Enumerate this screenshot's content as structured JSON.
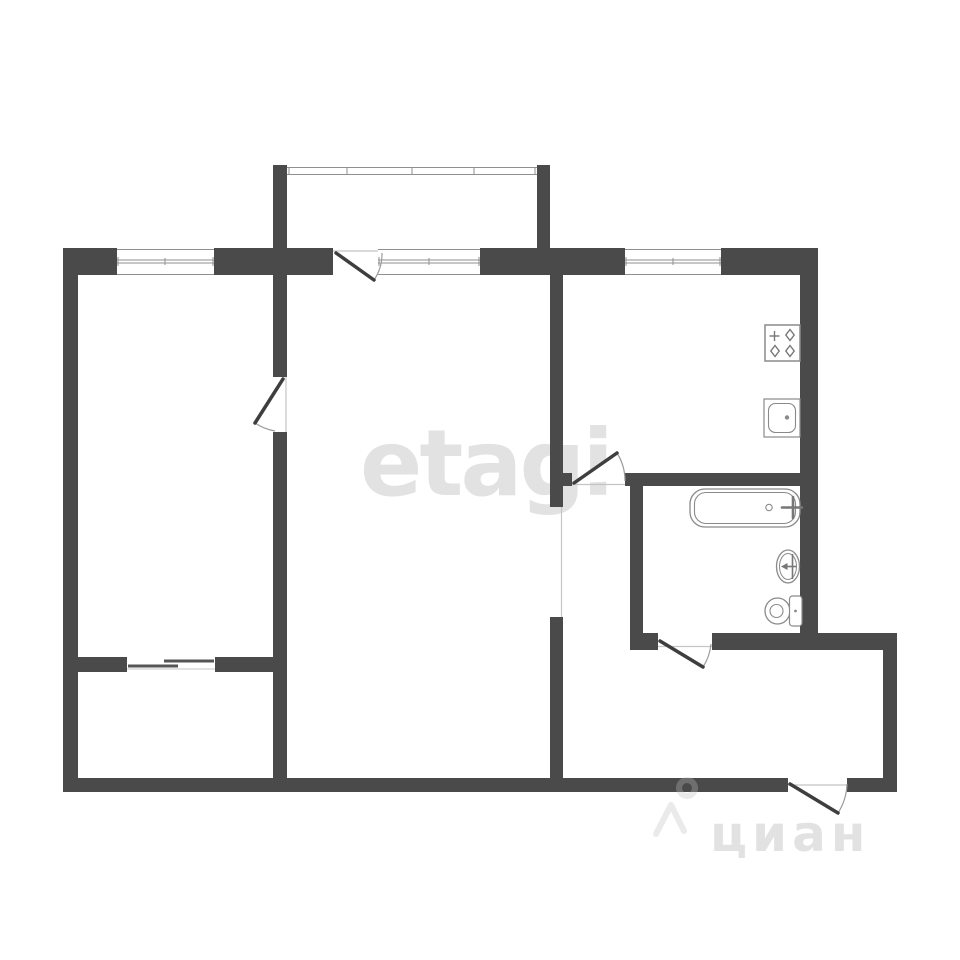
{
  "watermarks": {
    "primary": "etagi",
    "secondary": "циан"
  },
  "colors": {
    "wall": "#4a4a4a",
    "line": "#8f8f8f",
    "fixture": "#8a8a8a",
    "door": "#3e3e3e",
    "arc": "#9a9a9a",
    "threshold": "#c4c4c4",
    "wm1": "rgba(138,132,135,0.24)",
    "wm2": "rgba(150,150,150,0.28)",
    "wm2stroke": "rgba(190,190,190,0.32)",
    "bg": "#ffffff"
  },
  "icons": {
    "stove-icon": "square hob with four burner stars",
    "kitchen-sink-icon": "square basin with rounded inner bowl and drain dot",
    "bathtub-icon": "rounded rectangle tub with drain circle and tap cross",
    "washbasin-icon": "oval basin with tap arrow",
    "toilet-icon": "round bowl with cistern tank",
    "cian-pin-icon": "ring head with chevron legs",
    "door-icon": "leaf line with quarter-circle swing arc",
    "sliding-door-icon": "two offset overlapping panels",
    "window-icon": "white band with double glazing line"
  }
}
